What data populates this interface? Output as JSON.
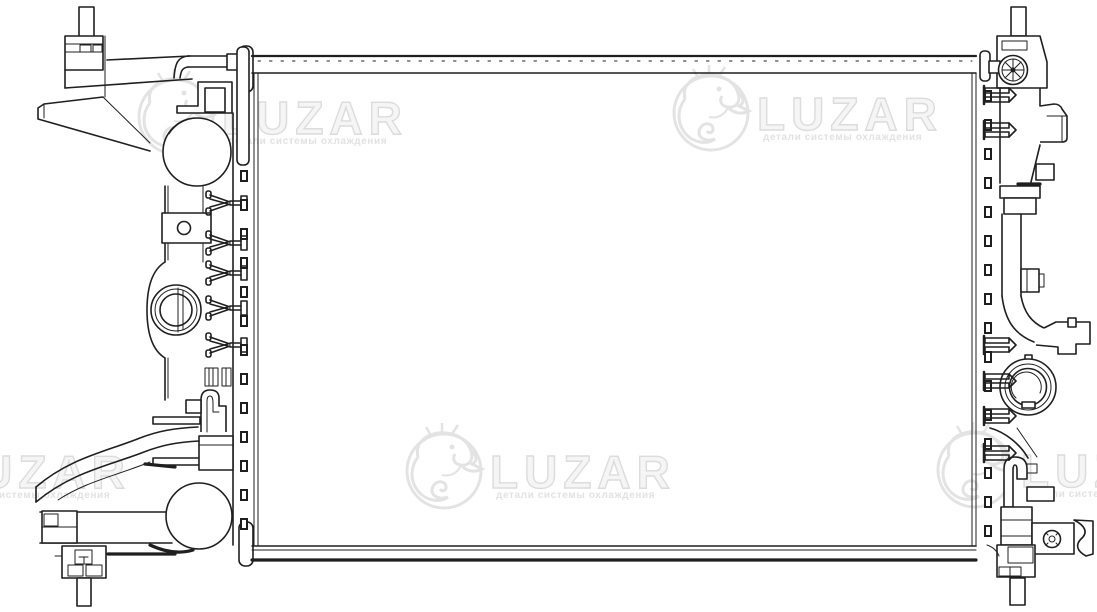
{
  "illustration": {
    "kind": "technical-line-drawing",
    "subject": "automotive-radiator-front-view"
  },
  "watermark": {
    "brand": "LUZAR",
    "tagline": "детали системы охлаждения",
    "emblem": "dragon-emblem-icon",
    "color": "#e3e3e3"
  },
  "colors": {
    "background": "#ffffff",
    "line": "#1f1f1f"
  }
}
